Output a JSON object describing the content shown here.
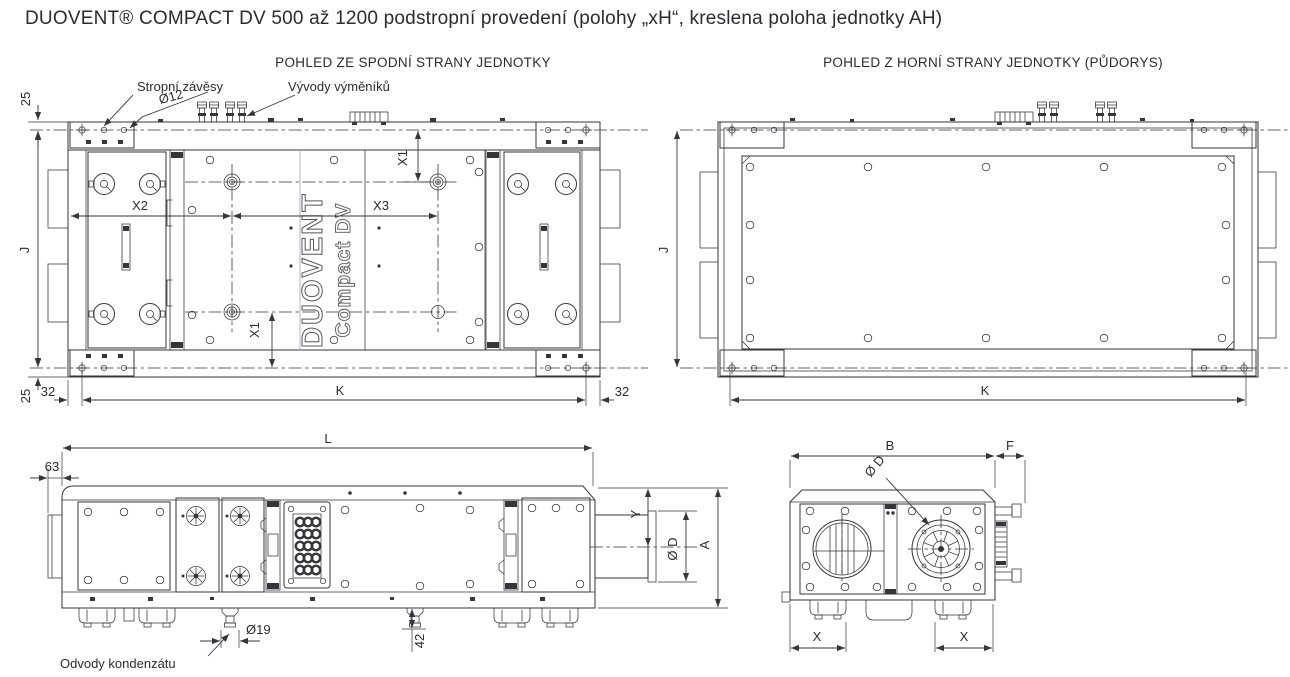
{
  "title": "DUOVENT® COMPACT DV 500 až 1200 podstropní provedení  (polohy „xH“, kreslena poloha jednotky AH)",
  "view_bottom": {
    "title": "POHLED ZE SPODNÍ STRANY JEDNOTKY",
    "label_hangers": "Stropní závěsy",
    "label_exchanger_outlets": "Vývody výměníků",
    "brand_line1": "DUOVENT",
    "brand_line2": "Compact DV",
    "dims": {
      "hanger_hole_dia": "Ø12",
      "top_offset": "25",
      "bottom_offset": "25",
      "left_margin": "32",
      "right_margin": "32",
      "x1_top": "X1",
      "x1_bottom": "X1",
      "x2": "X2",
      "x3": "X3",
      "width_j": "J",
      "length_k": "K"
    }
  },
  "view_top": {
    "title": "POHLED Z HORNÍ STRANY JEDNOTKY (PŮDORYS)",
    "dims": {
      "width_j": "J",
      "length_k": "K"
    }
  },
  "view_side": {
    "label_condensate": "Odvody kondenzátu",
    "dims": {
      "length_l": "L",
      "front_offset": "63",
      "duct_offset_y": "Y",
      "duct_dia": "Ø D",
      "height_a": "A",
      "drain_dia": "Ø19",
      "drain_height": "42"
    }
  },
  "view_end": {
    "dims": {
      "width_b": "B",
      "pipe_ext_f": "F",
      "fan_dia": "Ø D",
      "x_left": "X",
      "x_right": "X"
    }
  }
}
